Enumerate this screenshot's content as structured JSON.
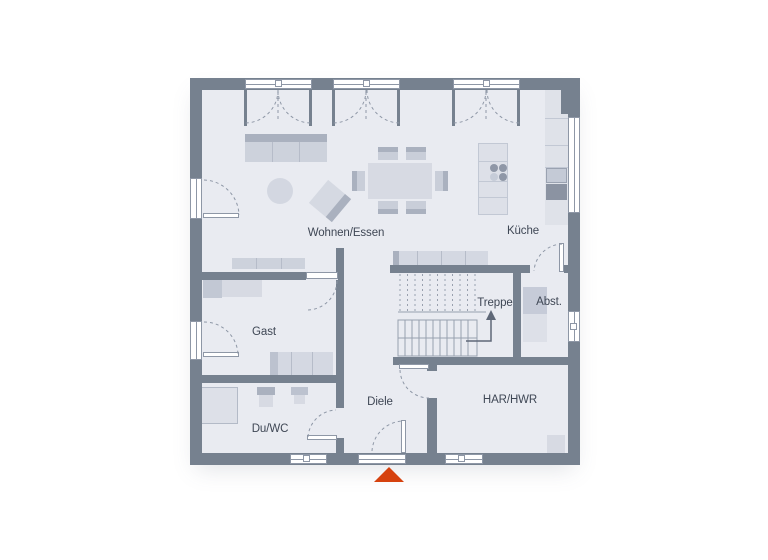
{
  "title": "Erdgeschoss Grundriss",
  "rooms": {
    "living_dining": {
      "label": "Wohnen/Essen"
    },
    "kitchen": {
      "label": "Küche"
    },
    "guest": {
      "label": "Gast"
    },
    "stairs": {
      "label": "Treppe"
    },
    "storage": {
      "label": "Abst."
    },
    "hallway": {
      "label": "Diele"
    },
    "shower_wc": {
      "label": "Du/WC"
    },
    "utility": {
      "label": "HAR/HWR"
    }
  },
  "markers": {
    "entrance": "red-triangle-up",
    "stair_direction": "arrow-up"
  },
  "colors": {
    "background": "#ffffff",
    "wall": "#76818f",
    "room_fill": "#e9ebf1",
    "furniture_light": "#d7dae3",
    "furniture_medium": "#c9ced9",
    "furniture_dark": "#aab1bf",
    "frame_line": "#8e97a6",
    "label_text": "#3f4755",
    "entrance_marker": "#d6420f"
  }
}
